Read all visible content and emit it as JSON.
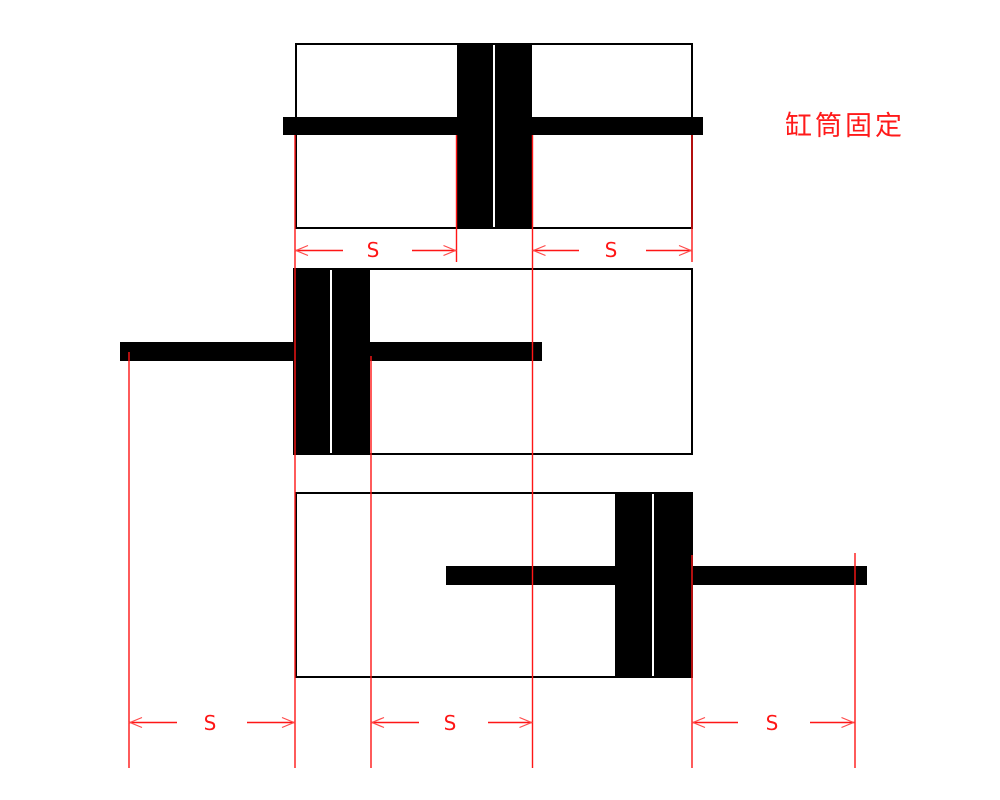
{
  "annotation": {
    "label": "缸筒固定"
  },
  "dimensions": {
    "row1": [
      {
        "label": "S"
      },
      {
        "label": "S"
      }
    ],
    "row2": [
      {
        "label": "S"
      },
      {
        "label": "S"
      },
      {
        "label": "S"
      }
    ]
  },
  "figures": [
    {
      "name": "piston-centered-double-rod"
    },
    {
      "name": "piston-full-left"
    },
    {
      "name": "piston-full-right"
    }
  ],
  "colors": {
    "accent": "#fe1616",
    "ink": "#000000",
    "background": "#ffffff"
  }
}
